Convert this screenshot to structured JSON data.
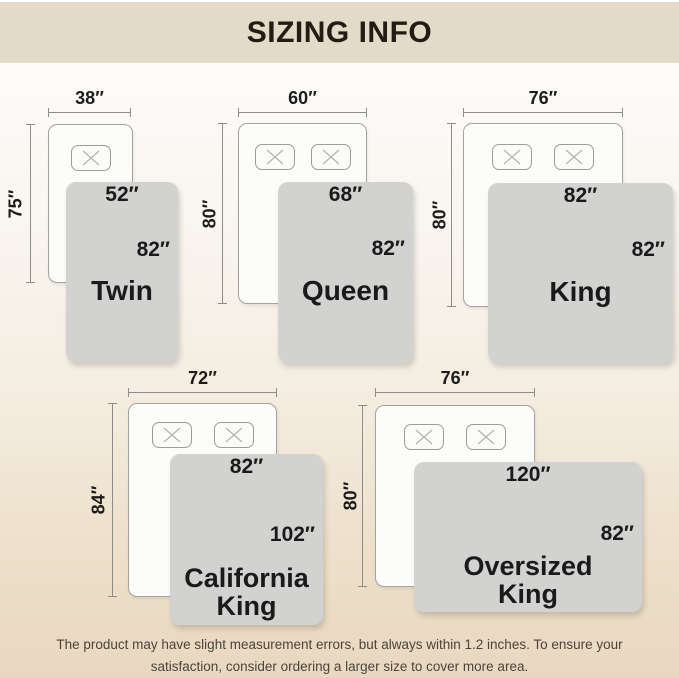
{
  "header": {
    "title": "SIZING INFO"
  },
  "colors": {
    "header_bg": "#e4dac8",
    "page_bottom": "#e9d8c1",
    "blanket": "#d2d2d1",
    "bed_fill": "#fcfcfb",
    "outline": "#8c8c8c",
    "text": "#1a1a1a"
  },
  "sizes": [
    {
      "name": "Twin",
      "bed_width": "38″",
      "bed_length": "75″",
      "blanket_width": "52″",
      "blanket_length": "82″",
      "pillows": 1
    },
    {
      "name": "Queen",
      "bed_width": "60″",
      "bed_length": "80″",
      "blanket_width": "68″",
      "blanket_length": "82″",
      "pillows": 2
    },
    {
      "name": "King",
      "bed_width": "76″",
      "bed_length": "80″",
      "blanket_width": "82″",
      "blanket_length": "82″",
      "pillows": 2
    },
    {
      "name": "California King",
      "bed_width": "72″",
      "bed_length": "84″",
      "blanket_width": "82″",
      "blanket_length": "102″",
      "pillows": 2
    },
    {
      "name": "Oversized King",
      "bed_width": "76″",
      "bed_length": "80″",
      "blanket_width": "120″",
      "blanket_length": "82″",
      "pillows": 2
    }
  ],
  "footer": {
    "line1": "The product may have slight measurement errors, but always within 1.2 inches. To ensure your",
    "line2": "satisfaction, consider ordering a larger size to cover more area."
  }
}
